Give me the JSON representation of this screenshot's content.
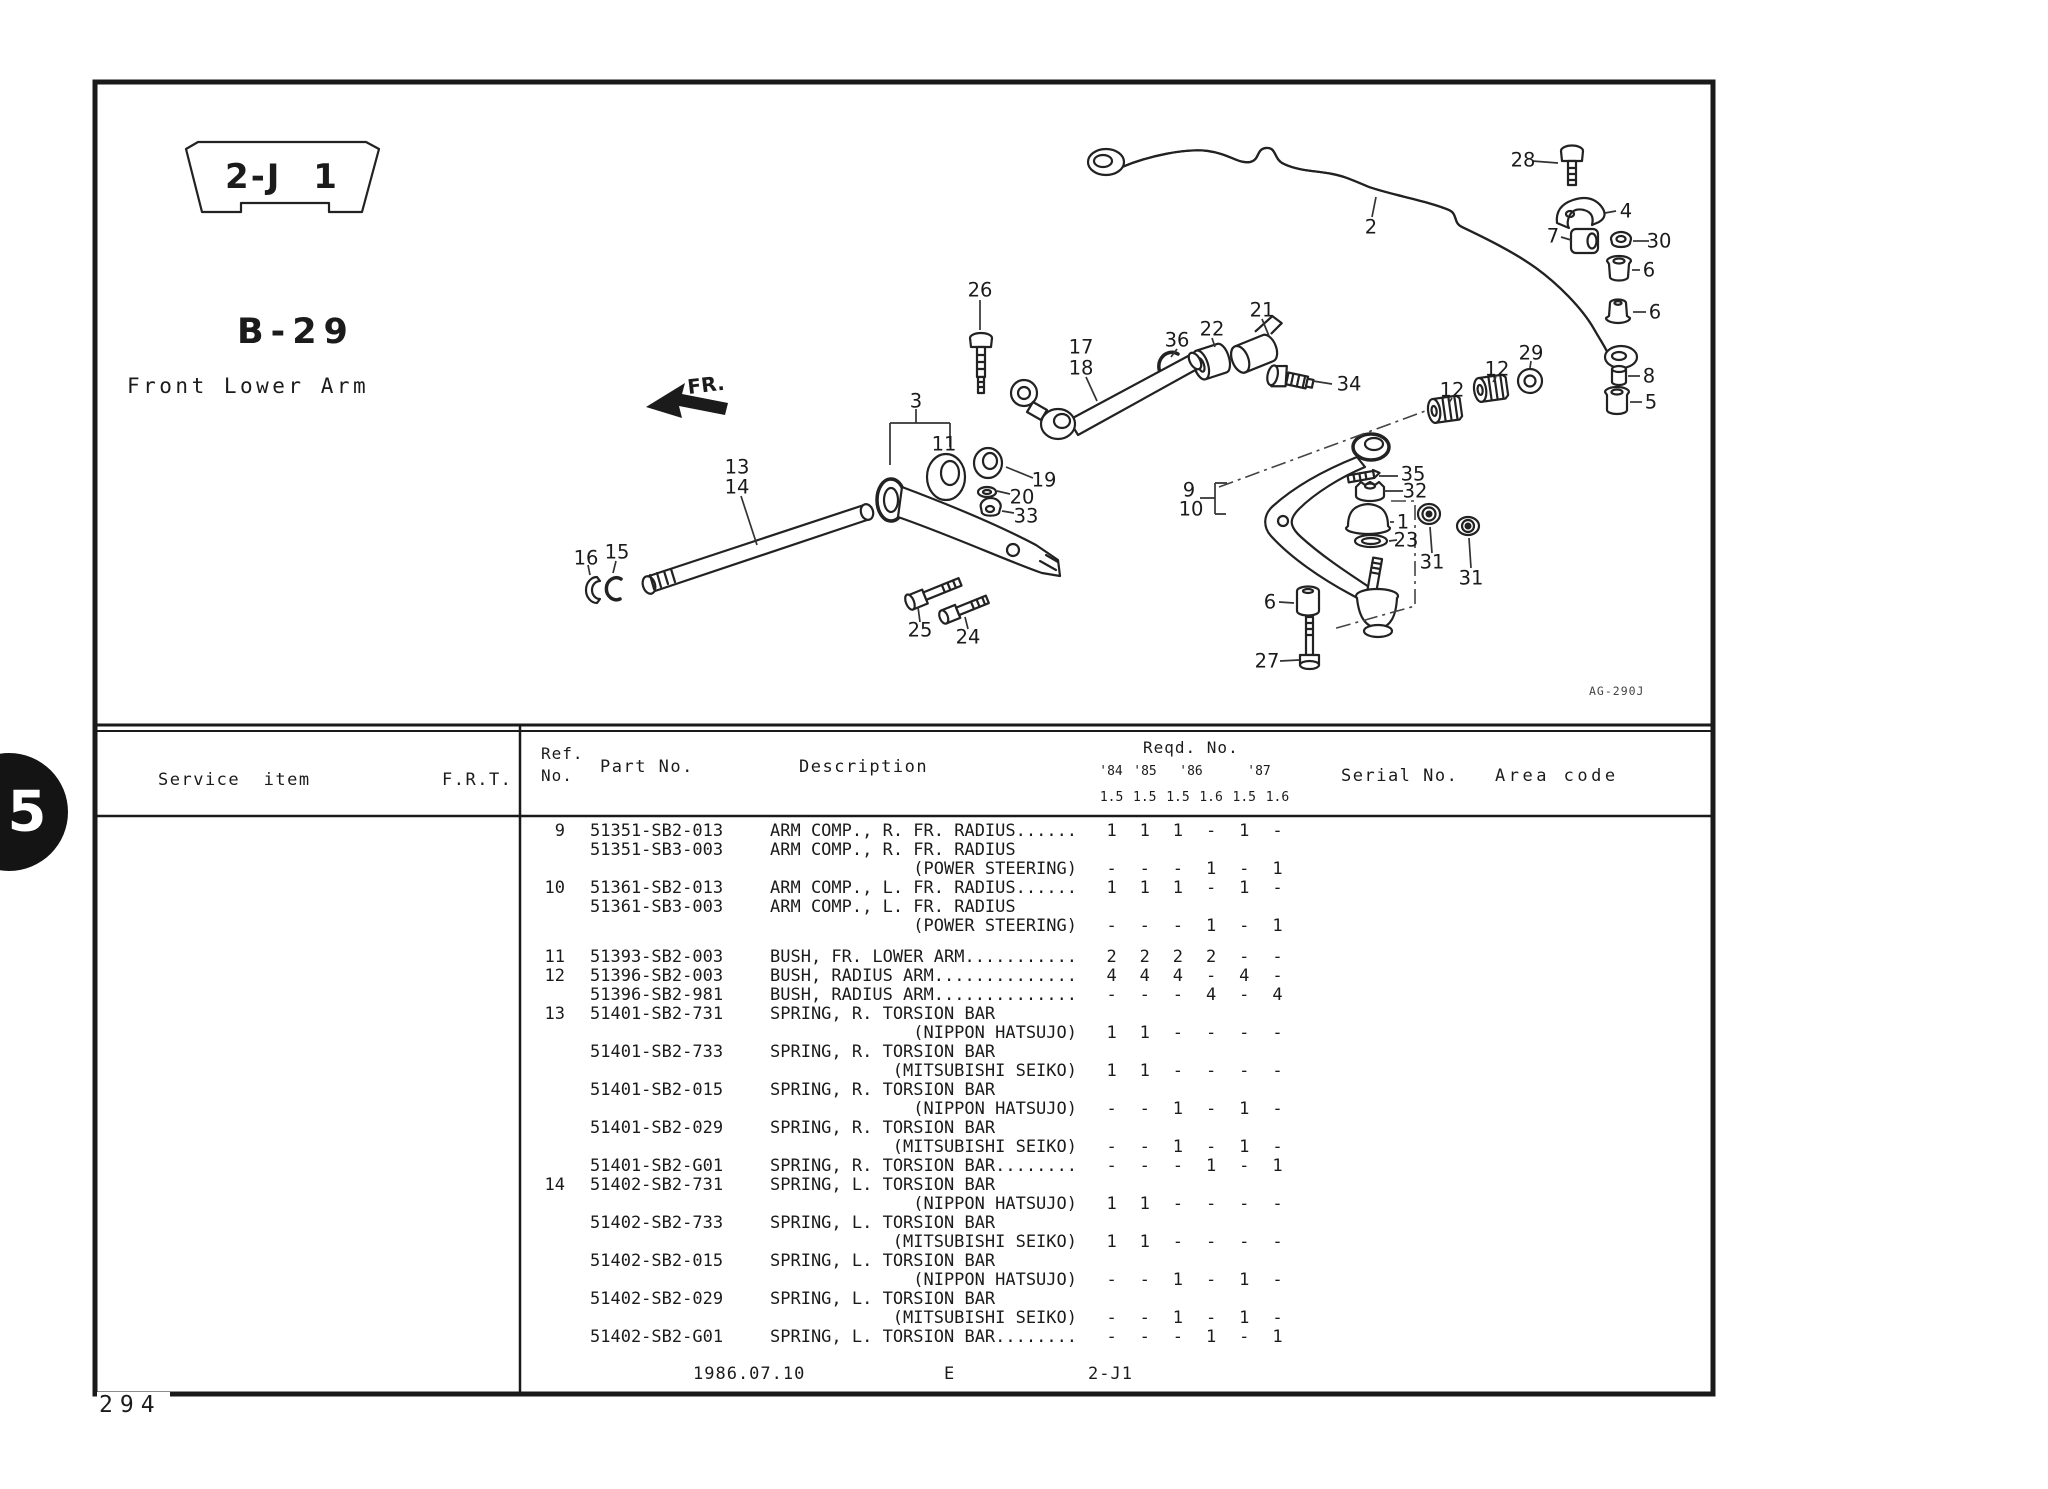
{
  "page": {
    "tab_number": "5",
    "page_number": "294",
    "section_badge": "2-J 1",
    "catalog_code": "B-29",
    "diagram_title": "Front Lower Arm",
    "direction_label": "FR.",
    "drawing_ref": "AG-290J"
  },
  "diagram": {
    "callouts": [
      {
        "label": "28",
        "x": 1523,
        "y": 160
      },
      {
        "label": "2",
        "x": 1371,
        "y": 227
      },
      {
        "label": "4",
        "x": 1626,
        "y": 211
      },
      {
        "label": "7",
        "x": 1553,
        "y": 236
      },
      {
        "label": "30",
        "x": 1659,
        "y": 241
      },
      {
        "label": "6",
        "x": 1649,
        "y": 270
      },
      {
        "label": "6",
        "x": 1655,
        "y": 312
      },
      {
        "label": "8",
        "x": 1649,
        "y": 376
      },
      {
        "label": "5",
        "x": 1651,
        "y": 402
      },
      {
        "label": "29",
        "x": 1531,
        "y": 353
      },
      {
        "label": "12",
        "x": 1497,
        "y": 369
      },
      {
        "label": "12",
        "x": 1452,
        "y": 390
      },
      {
        "label": "26",
        "x": 980,
        "y": 290
      },
      {
        "label": "21",
        "x": 1262,
        "y": 310
      },
      {
        "label": "22",
        "x": 1212,
        "y": 329
      },
      {
        "label": "36",
        "x": 1177,
        "y": 340
      },
      {
        "label": "34",
        "x": 1349,
        "y": 384
      },
      {
        "label": "17",
        "x": 1081,
        "y": 347
      },
      {
        "label": "18",
        "x": 1081,
        "y": 368
      },
      {
        "label": "3",
        "x": 916,
        "y": 401
      },
      {
        "label": "11",
        "x": 944,
        "y": 444
      },
      {
        "label": "13",
        "x": 737,
        "y": 467
      },
      {
        "label": "14",
        "x": 737,
        "y": 487
      },
      {
        "label": "19",
        "x": 1044,
        "y": 480
      },
      {
        "label": "20",
        "x": 1022,
        "y": 497
      },
      {
        "label": "33",
        "x": 1026,
        "y": 516
      },
      {
        "label": "9",
        "x": 1189,
        "y": 490
      },
      {
        "label": "10",
        "x": 1191,
        "y": 509
      },
      {
        "label": "35",
        "x": 1413,
        "y": 474
      },
      {
        "label": "32",
        "x": 1415,
        "y": 491
      },
      {
        "label": "1",
        "x": 1403,
        "y": 522
      },
      {
        "label": "23",
        "x": 1406,
        "y": 540
      },
      {
        "label": "31",
        "x": 1432,
        "y": 562
      },
      {
        "label": "31",
        "x": 1471,
        "y": 578
      },
      {
        "label": "16",
        "x": 586,
        "y": 558
      },
      {
        "label": "15",
        "x": 617,
        "y": 552
      },
      {
        "label": "25",
        "x": 920,
        "y": 630
      },
      {
        "label": "24",
        "x": 968,
        "y": 637
      },
      {
        "label": "6",
        "x": 1270,
        "y": 602
      },
      {
        "label": "27",
        "x": 1267,
        "y": 661
      }
    ]
  },
  "table": {
    "headers": {
      "service_item": "Service  item",
      "frt": "F.R.T.",
      "ref_line1": "Ref.",
      "ref_line2": "No.",
      "part_no": "Part No.",
      "description": "Description",
      "reqd_no": "Reqd. No.",
      "years": [
        "'84",
        "'85",
        "'86",
        "'87"
      ],
      "engines": [
        "1.5",
        "1.5",
        "1.5",
        "1.6",
        "1.5",
        "1.6"
      ],
      "serial_no": "Serial No.",
      "area_code": "Area code"
    },
    "rows": [
      {
        "ref": "9",
        "part": "51351-SB2-013",
        "desc": "ARM COMP., R. FR. RADIUS......",
        "qty": [
          "1",
          "1",
          "1",
          "-",
          "1",
          "-"
        ]
      },
      {
        "part": "51351-SB3-003",
        "desc": "ARM COMP., R. FR. RADIUS"
      },
      {
        "desc": "(POWER STEERING)",
        "qty": [
          "-",
          "-",
          "-",
          "1",
          "-",
          "1"
        ]
      },
      {
        "ref": "10",
        "part": "51361-SB2-013",
        "desc": "ARM COMP., L. FR. RADIUS......",
        "qty": [
          "1",
          "1",
          "1",
          "-",
          "1",
          "-"
        ]
      },
      {
        "part": "51361-SB3-003",
        "desc": "ARM COMP., L. FR. RADIUS"
      },
      {
        "desc": "(POWER STEERING)",
        "qty": [
          "-",
          "-",
          "-",
          "1",
          "-",
          "1"
        ]
      },
      {
        "blank": true
      },
      {
        "ref": "11",
        "part": "51393-SB2-003",
        "desc": "BUSH, FR. LOWER ARM...........",
        "qty": [
          "2",
          "2",
          "2",
          "2",
          "-",
          "-"
        ]
      },
      {
        "ref": "12",
        "part": "51396-SB2-003",
        "desc": "BUSH, RADIUS ARM..............",
        "qty": [
          "4",
          "4",
          "4",
          "-",
          "4",
          "-"
        ]
      },
      {
        "part": "51396-SB2-981",
        "desc": "BUSH, RADIUS ARM..............",
        "qty": [
          "-",
          "-",
          "-",
          "4",
          "-",
          "4"
        ]
      },
      {
        "ref": "13",
        "part": "51401-SB2-731",
        "desc": "SPRING, R. TORSION BAR"
      },
      {
        "desc": "(NIPPON HATSUJO)",
        "qty": [
          "1",
          "1",
          "-",
          "-",
          "-",
          "-"
        ]
      },
      {
        "part": "51401-SB2-733",
        "desc": "SPRING, R. TORSION BAR"
      },
      {
        "desc": "(MITSUBISHI SEIKO)",
        "qty": [
          "1",
          "1",
          "-",
          "-",
          "-",
          "-"
        ]
      },
      {
        "part": "51401-SB2-015",
        "desc": "SPRING, R. TORSION BAR"
      },
      {
        "desc": "(NIPPON HATSUJO)",
        "qty": [
          "-",
          "-",
          "1",
          "-",
          "1",
          "-"
        ]
      },
      {
        "part": "51401-SB2-029",
        "desc": "SPRING, R. TORSION BAR"
      },
      {
        "desc": "(MITSUBISHI SEIKO)",
        "qty": [
          "-",
          "-",
          "1",
          "-",
          "1",
          "-"
        ]
      },
      {
        "part": "51401-SB2-G01",
        "desc": "SPRING, R. TORSION BAR........",
        "qty": [
          "-",
          "-",
          "-",
          "1",
          "-",
          "1"
        ]
      },
      {
        "ref": "14",
        "part": "51402-SB2-731",
        "desc": "SPRING, L. TORSION BAR"
      },
      {
        "desc": "(NIPPON HATSUJO)",
        "qty": [
          "1",
          "1",
          "-",
          "-",
          "-",
          "-"
        ]
      },
      {
        "part": "51402-SB2-733",
        "desc": "SPRING, L. TORSION BAR"
      },
      {
        "desc": "(MITSUBISHI SEIKO)",
        "qty": [
          "1",
          "1",
          "-",
          "-",
          "-",
          "-"
        ]
      },
      {
        "part": "51402-SB2-015",
        "desc": "SPRING, L. TORSION BAR"
      },
      {
        "desc": "(NIPPON HATSUJO)",
        "qty": [
          "-",
          "-",
          "1",
          "-",
          "1",
          "-"
        ]
      },
      {
        "part": "51402-SB2-029",
        "desc": "SPRING, L. TORSION BAR"
      },
      {
        "desc": "(MITSUBISHI SEIKO)",
        "qty": [
          "-",
          "-",
          "1",
          "-",
          "1",
          "-"
        ]
      },
      {
        "part": "51402-SB2-G01",
        "desc": "SPRING, L. TORSION BAR........",
        "qty": [
          "-",
          "-",
          "-",
          "1",
          "-",
          "1"
        ]
      }
    ],
    "footer": {
      "date": "1986.07.10",
      "code": "E",
      "section": "2-J1"
    }
  }
}
